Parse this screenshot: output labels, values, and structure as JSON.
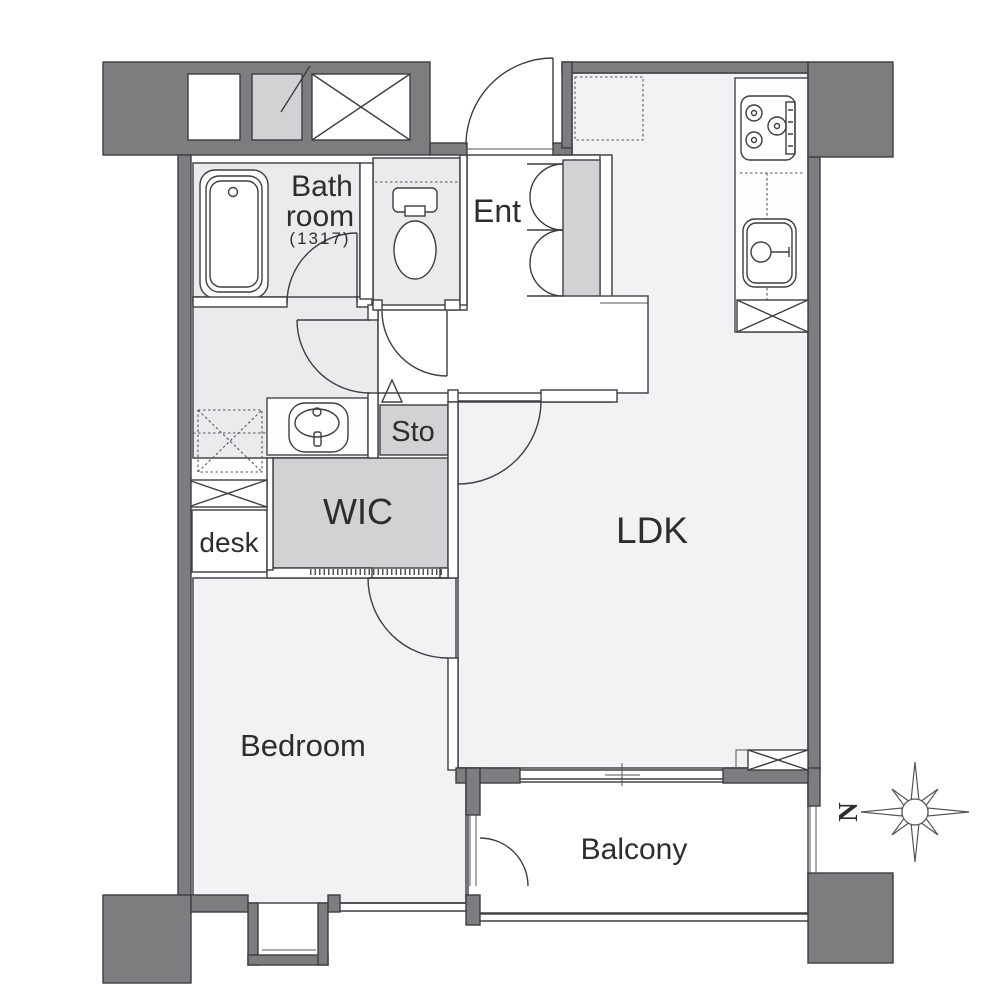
{
  "document_type": "apartment-floor-plan",
  "labels": {
    "bath_line1": "Bath",
    "bath_line2": "room",
    "bath_size": "(1317)",
    "ent": "Ent",
    "sto": "Sto",
    "wic": "WIC",
    "desk": "desk",
    "ldk": "LDK",
    "bedroom": "Bedroom",
    "balcony": "Balcony",
    "north": "N"
  },
  "icons": [
    "bathtub-icon",
    "toilet-icon",
    "washbasin-icon",
    "stove-icon",
    "kitchen-sink-icon",
    "washing-machine-space-icon",
    "refrigerator-space-icon",
    "shoe-cabinet-doors-icon",
    "pipe-space-icon",
    "elevator-shaft-icon",
    "door-swing-arc-icon",
    "compass-icon",
    "bay-window-icon"
  ],
  "colors": {
    "structural_wall": "#7d7d80",
    "wet_room_fill": "#ebebee",
    "room_fill": "#f2f2f4",
    "closet_fill": "#d2d2d4",
    "counter_fill": "#fdfdfd",
    "outline": "#3e3e42",
    "text": "#2d2d2f",
    "background": "#ffffff"
  }
}
